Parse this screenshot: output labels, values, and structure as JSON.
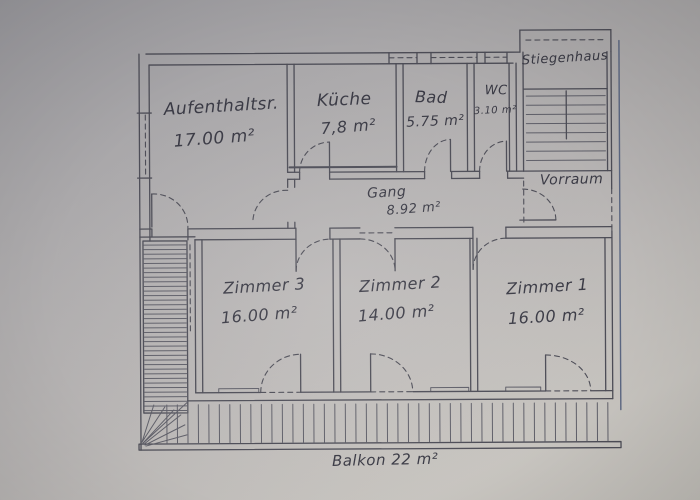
{
  "document": {
    "kind": "hand-drawn floor plan sketch (photo)",
    "language": "German"
  },
  "colors": {
    "paper": "#bcb9b8",
    "ink": "#4e4e58",
    "pencil": "#60606a"
  },
  "rooms": [
    {
      "id": "aufenthaltsraum",
      "name": "Aufenthaltsr.",
      "area": "17.00 m²"
    },
    {
      "id": "kueche",
      "name": "Küche",
      "area": "7,8 m²"
    },
    {
      "id": "bad",
      "name": "Bad",
      "area": "5.75 m²"
    },
    {
      "id": "wc",
      "name": "WC",
      "area": "3.10 m²"
    },
    {
      "id": "stiegenhaus",
      "name": "Stiegenhaus",
      "area": ""
    },
    {
      "id": "vorraum",
      "name": "Vorraum",
      "area": ""
    },
    {
      "id": "gang",
      "name": "Gang",
      "area": "8.92 m²"
    },
    {
      "id": "zimmer3",
      "name": "Zimmer 3",
      "area": "16.00 m²"
    },
    {
      "id": "zimmer2",
      "name": "Zimmer 2",
      "area": "14.00 m²"
    },
    {
      "id": "zimmer1",
      "name": "Zimmer 1",
      "area": "16.00 m²"
    },
    {
      "id": "balkon",
      "name": "Balkon",
      "area": "22 m²"
    }
  ]
}
